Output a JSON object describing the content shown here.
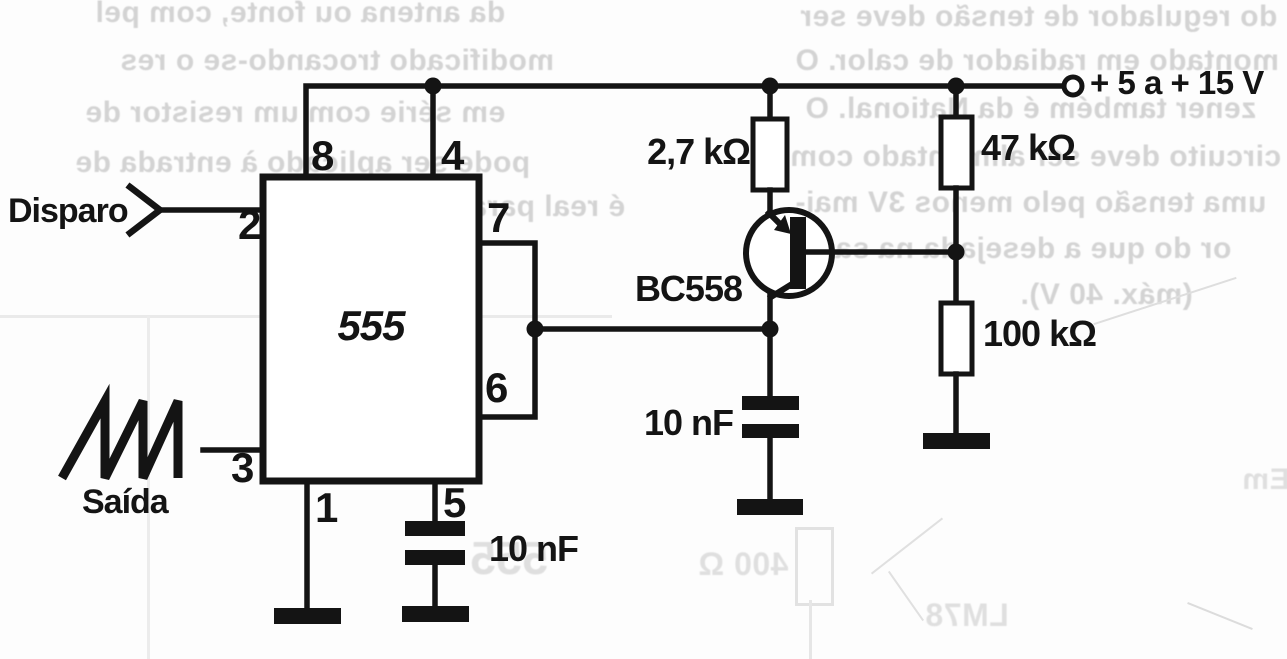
{
  "page": {
    "background": "#fdfdfd",
    "ink": "#141414",
    "ghost_color": "#c6c6c6"
  },
  "labels": {
    "supply": "+ 5 a + 15 V",
    "trigger": "Disparo",
    "output": "Saída",
    "ic": "555",
    "transistor": "BC558",
    "r_emitter": "2,7 kΩ",
    "r_base_upper": "47 kΩ",
    "r_base_lower": "100 kΩ",
    "c_control": "10 nF",
    "c_collector": "10 nF",
    "pin1": "1",
    "pin2": "2",
    "pin3": "3",
    "pin4": "4",
    "pin5": "5",
    "pin6": "6",
    "pin7": "7",
    "pin8": "8"
  },
  "ghost": {
    "left": [
      "da antena ou fonte, com pel",
      "modificado trocando-se o res",
      "em série com um resistor de",
      "pode ser aplicado à entrada de",
      "é real para alarmes."
    ],
    "right": [
      "do regulador de tensão deve ser",
      "montado em radiador de calor. O",
      "zener também é da National. O",
      "circuito deve ser alimentado com",
      "uma tensão pelo menos 3V mai-",
      "or do que a desejada na saída",
      "(máx. 40 V)."
    ],
    "bottom": [
      "555",
      "400 Ω",
      "LM78",
      "Em"
    ]
  }
}
